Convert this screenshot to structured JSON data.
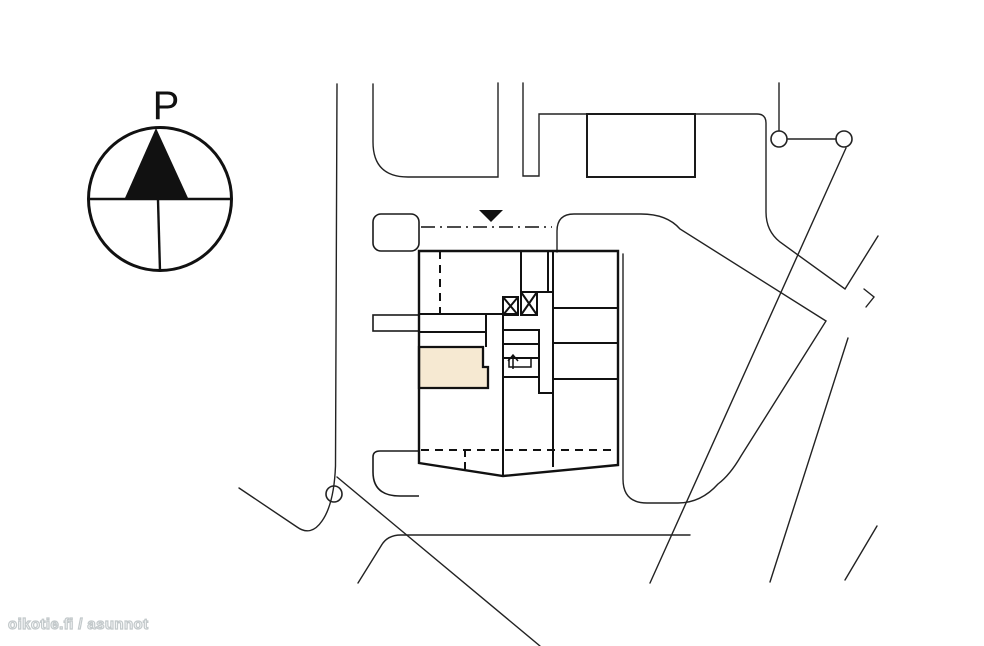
{
  "plan": {
    "type": "site-plan",
    "compass": {
      "north_label": "P"
    },
    "watermark": {
      "text": "oikotie.fi / asunnot",
      "color": "#c3c9cb"
    },
    "colors": {
      "background": "#ffffff",
      "line_thin": "#222222",
      "line_thick": "#111111",
      "highlight_unit": "#f6e9d2",
      "marker": "#111111"
    },
    "elements": {
      "highlighted_unit": "highlighted-apartment",
      "triangle_marker": "entrance-marker",
      "crossed_boxes": "elevator-shafts",
      "arrow_box": "stairwell",
      "dash_dot_line": "boundary-line",
      "circles": "survey-points"
    }
  }
}
